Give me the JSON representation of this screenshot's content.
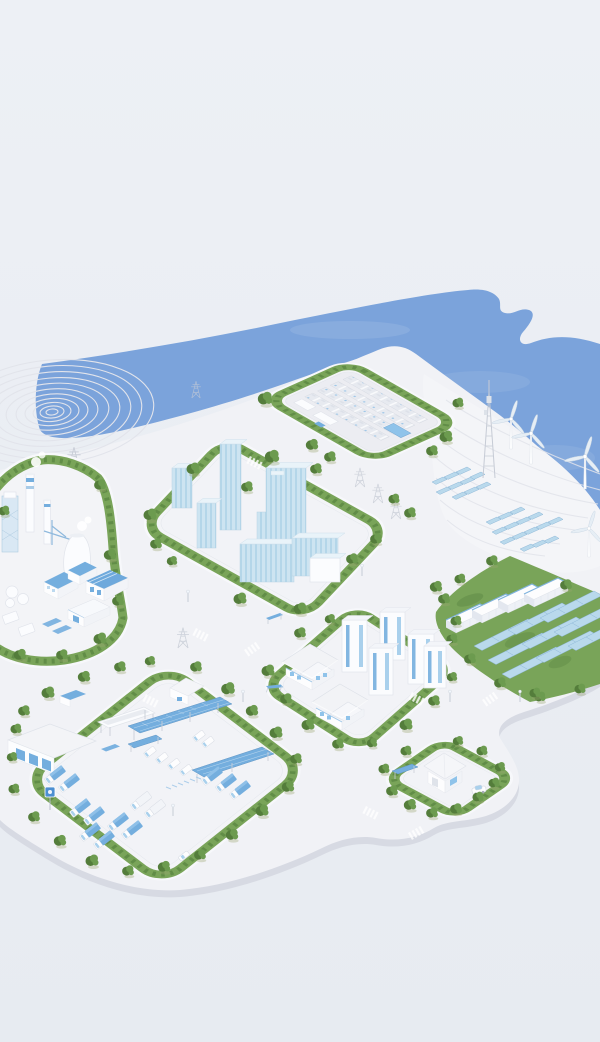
{
  "scene": {
    "description": "Isometric 3D illustration of a coastal smart-energy city campus: white clay-style buildings on a rounded white platform, green hedge rings and trees, blue sea along the upper coastline",
    "style": "minimal white / light-blue 3D render, no text or UI elements",
    "zones": [
      {
        "id": "coastal-water",
        "type": "sea",
        "detail": "flat blue water with curved coastline and small inlet hook at top right"
      },
      {
        "id": "terraced-hill-west",
        "type": "contour-terraced mound",
        "contour_rings": 11
      },
      {
        "id": "renewable-hill-east",
        "type": "terraced coastal slope",
        "wind_turbines": 4,
        "solar_panel_clusters": 2,
        "small_solar_panels": 25
      },
      {
        "id": "substation",
        "type": "electrical substation",
        "hedge_ring": true,
        "equipment_rows": 4,
        "white_control_cabins": 2,
        "blue_roof_unit": 1,
        "blue_signboard": 1
      },
      {
        "id": "communications-tower",
        "type": "lattice telecom mast",
        "count": 1
      },
      {
        "id": "industrial-plant",
        "type": "factory district",
        "hedge_ring": true,
        "chimneys": 2,
        "cooling_tower": 1,
        "blue_roof_buildings": 4,
        "storage_tanks": 3,
        "crane": 1,
        "lattice_tower": 1
      },
      {
        "id": "downtown",
        "type": "glass office district",
        "hedge_ring": true,
        "glass_towers": 4,
        "podium_blocks": 3
      },
      {
        "id": "battery-solar-farm",
        "type": "energy storage and solar field on grass",
        "battery_containers": 4,
        "solar_array_rows": 9
      },
      {
        "id": "residential",
        "type": "housing district",
        "hedge_ring": true,
        "apartment_towers": 5,
        "villas": 2
      },
      {
        "id": "logistics-depot",
        "type": "truck depot",
        "hedge_ring": true,
        "gable_warehouse": 1,
        "gate_hut": 1,
        "blue_shed": 1,
        "white_canopy": 1,
        "solar_canopies": 3,
        "blue_signboard": 1
      },
      {
        "id": "charging-station",
        "type": "small service block with ring road",
        "kiosk": 1,
        "solar_canopy": 1
      },
      {
        "id": "transmission-pylons",
        "type": "power line lattice towers",
        "count": 8
      }
    ],
    "vehicles": {
      "cars": 2,
      "trucks": 13,
      "vans": 6
    },
    "street_furniture": {
      "street_lamps": 6,
      "crosswalks": 8,
      "bus_shelters": 2
    },
    "vegetation": "dense tree clusters along every hedge ring and road edge"
  },
  "palette": {
    "bg-top": "#edf0f5",
    "bg-bottom": "#e7ebf1",
    "water": "#7ba3db",
    "land": "#f1f2f6",
    "land-side": "#d7dae3",
    "pad": "#f3f4f7",
    "hedge": "#79a459",
    "hedge-dark": "#5b8742",
    "tree": "#6c9b4f",
    "tree-dark": "#547d3b",
    "building-white": "#fbfcfe",
    "building-shadow": "#e1e4eb",
    "glass": "#cde4f1",
    "glass-stripe": "#b4d6e9",
    "accent-blue": "#74aede",
    "solar": "#b9d9ec",
    "solar-edge": "#8fb8d8",
    "contour": "#e2e4eb",
    "metal": "#c6cbd5"
  }
}
